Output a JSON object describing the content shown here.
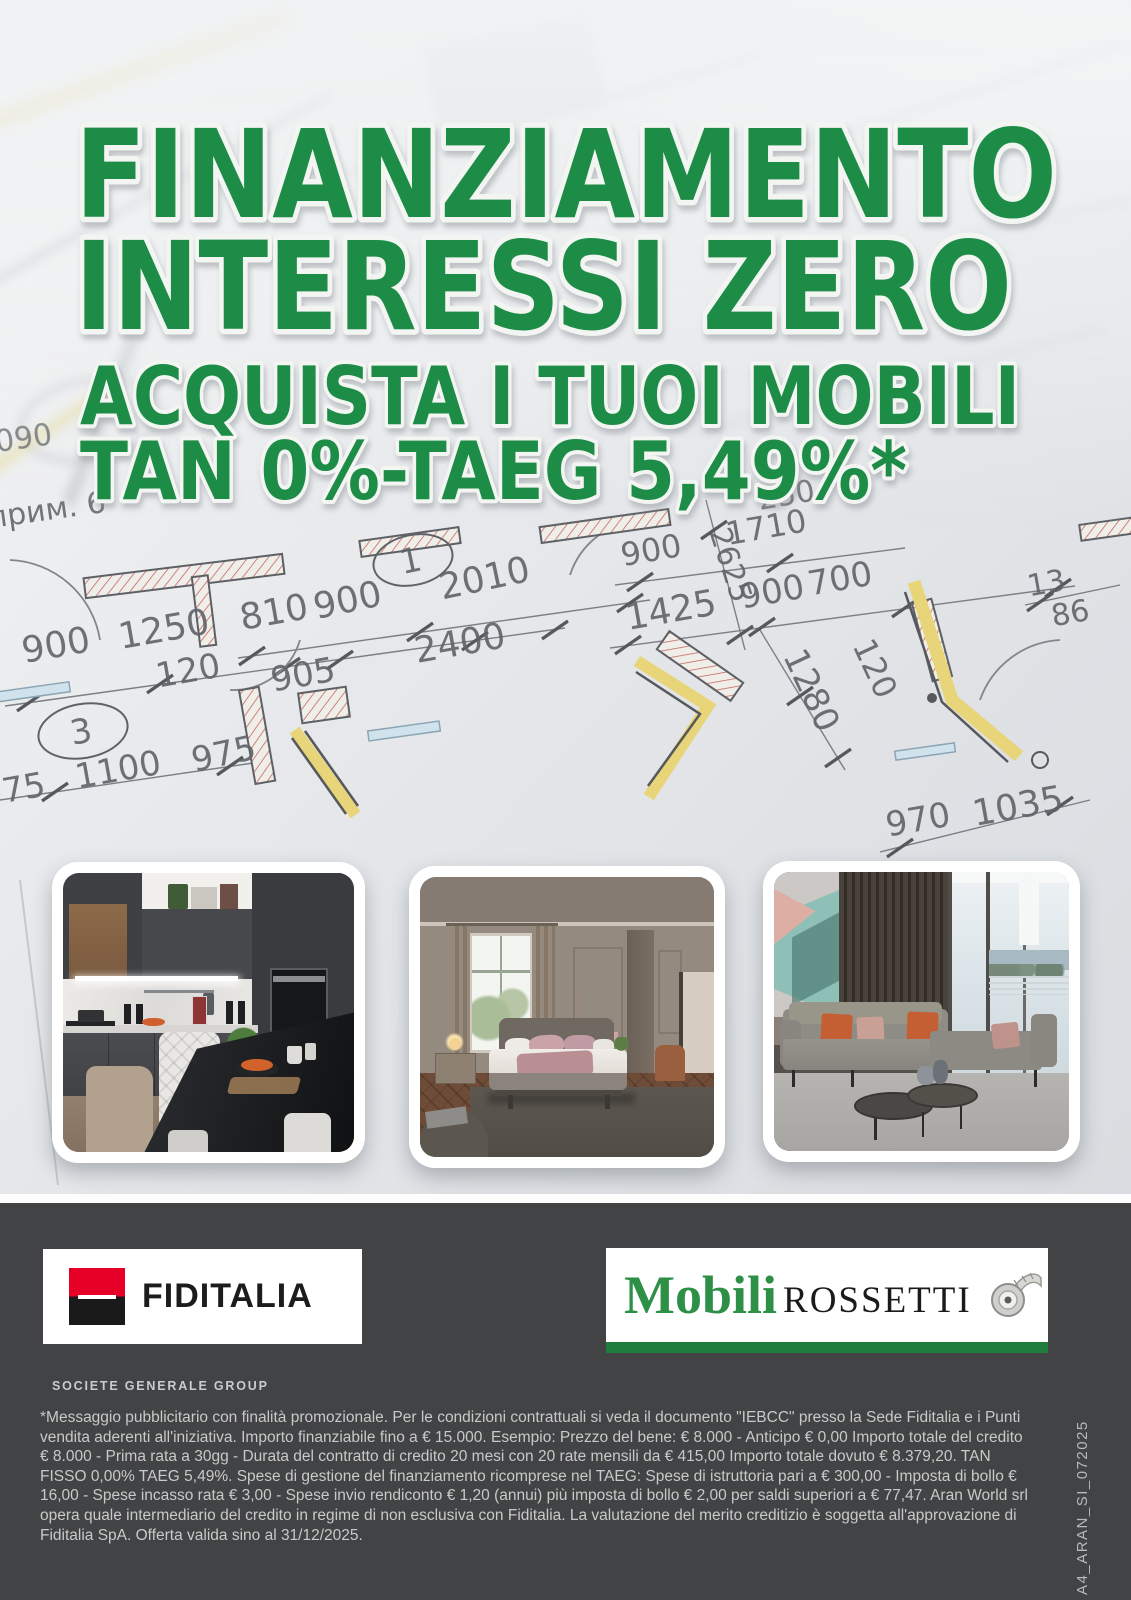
{
  "headline": {
    "line1": "FINANZIAMENTO",
    "line2": "INTERESSI ZERO",
    "line3": "ACQUISTA I TUOI MOBILI",
    "line4": "TAN 0%-TAEG 5,49%*",
    "color": "#1e8c47",
    "outline_color": "#f3f5f2"
  },
  "blueprint": {
    "labels": [
      "прим. 6",
      "1",
      "2010",
      "900",
      "810",
      "1250",
      "900",
      "120",
      "905",
      "2400",
      "3",
      "975",
      "1100",
      "975",
      "090",
      "250",
      "1710",
      "900",
      "2625",
      "1425",
      "900",
      "700",
      "1280",
      "120",
      "13",
      "86",
      "970",
      "1035"
    ]
  },
  "photos": [
    {
      "name": "kitchen"
    },
    {
      "name": "bedroom"
    },
    {
      "name": "living-room"
    }
  ],
  "footer": {
    "background": "#414344",
    "fiditalia": {
      "name": "FIDITALIA",
      "group": "SOCIETE GENERALE GROUP",
      "logo_red": "#e60028"
    },
    "rossetti": {
      "word1": "Mobili",
      "word2": "ROSSETTI",
      "green": "#2e8f47",
      "bar_green": "#1e7c3c"
    },
    "legal": "*Messaggio pubblicitario con finalità promozionale. Per le condizioni contrattuali si veda il documento \"IEBCC\" presso la Sede Fiditalia e i Punti vendita aderenti all'iniziativa. Importo finanziabile fino a € 15.000. Esempio: Prezzo del bene: € 8.000 - Anticipo € 0,00 Importo totale del credito € 8.000 - Prima rata a 30gg - Durata del contratto di credito 20 mesi con 20 rate mensili da € 415,00 Importo totale dovuto € 8.379,20. TAN FISSO 0,00% TAEG 5,49%. Spese di gestione del finanziamento ricomprese nel TAEG: Spese di istruttoria pari a € 300,00 - Imposta di bollo € 16,00 - Spese incasso rata € 3,00 - Spese invio rendiconto € 1,20 (annui) più imposta di bollo € 2,00 per saldi superiori a € 77,47. Aran World srl opera quale intermediario del credito in regime di non esclusiva con Fiditalia. La valutazione del merito creditizio è soggetta all'approvazione di Fiditalia SpA. Offerta valida sino al 31/12/2025.",
    "side_code": "A4_ARAN_SI_072025"
  }
}
